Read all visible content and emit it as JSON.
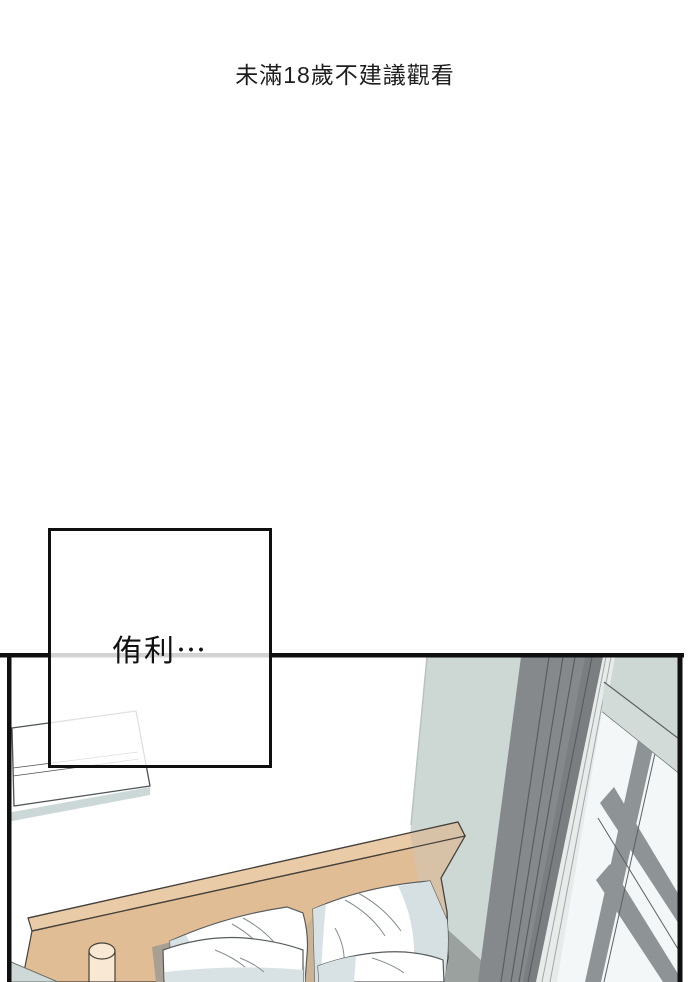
{
  "page": {
    "background": "#ffffff",
    "notice_text": "未滿18歲不建議觀看",
    "notice_color": "#1d1d1d"
  },
  "speech_bubble": {
    "text": "侑利⋯"
  },
  "panel": {
    "alt": "Tilted bedroom scene: bed with wooden headboard and white pillows, air conditioner on white wall, dark curtain pillar and cross-braced window on blue-gray wall"
  },
  "palette": {
    "ink": "#101010",
    "wall-blue": "#cdd7d4",
    "wall-line": "#b9c3c0",
    "pillar-gray": "#85898c",
    "pillar-dark": "#7a7e81",
    "pillar-line": "#595e61",
    "strip-light": "#e7eceb",
    "strip-line": "#9fa7a7",
    "window-bg": "#f3f7f7",
    "bar-gray": "#8e9396",
    "edge-dark": "#5b6063",
    "head-lit": "#e1bd96",
    "head-top": "#e9cba7",
    "head-shade": "#d8c2a7",
    "head-gap": "#cbb493",
    "outline-brown": "#45403a",
    "knob-cream": "#f9e9d4",
    "floor-gray": "#9ba19f",
    "sheet-light": "#edf2f2",
    "ac-shadow": "#ccd8d8",
    "ac-line": "#4e5356",
    "bedding-blue": "#ced8d7",
    "pillow-shade": "#d8e2e5",
    "pillow-line": "#848d91",
    "pillow-outline": "#565b5e",
    "shadow-warm": "#a9a094"
  }
}
